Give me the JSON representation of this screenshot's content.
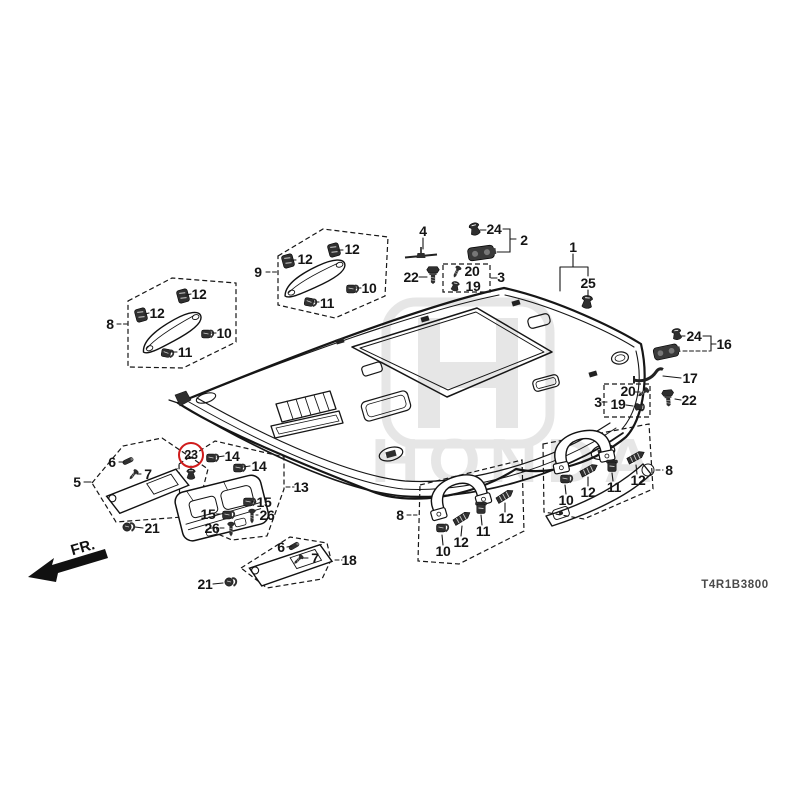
{
  "footer": {
    "diagram_code": "T4R1B3800"
  },
  "orientation": {
    "label": "FR."
  },
  "watermark": {
    "brand": "HONDA"
  },
  "highlight": {
    "label": "23",
    "ring_color": "#cf1b1b"
  },
  "callouts": [
    {
      "label": "4",
      "x": 423,
      "y": 231
    },
    {
      "label": "24",
      "x": 494,
      "y": 229
    },
    {
      "label": "2",
      "x": 524,
      "y": 240
    },
    {
      "label": "22",
      "x": 411,
      "y": 277
    },
    {
      "label": "20",
      "x": 472,
      "y": 271
    },
    {
      "label": "19",
      "x": 473,
      "y": 286
    },
    {
      "label": "3",
      "x": 501,
      "y": 277
    },
    {
      "label": "1",
      "x": 573,
      "y": 247
    },
    {
      "label": "25",
      "x": 588,
      "y": 283
    },
    {
      "label": "9",
      "x": 258,
      "y": 272
    },
    {
      "label": "12",
      "x": 305,
      "y": 259
    },
    {
      "label": "12",
      "x": 352,
      "y": 249
    },
    {
      "label": "10",
      "x": 369,
      "y": 288
    },
    {
      "label": "11",
      "x": 327,
      "y": 303
    },
    {
      "label": "8",
      "x": 110,
      "y": 324
    },
    {
      "label": "12",
      "x": 199,
      "y": 294
    },
    {
      "label": "12",
      "x": 157,
      "y": 313
    },
    {
      "label": "10",
      "x": 224,
      "y": 333
    },
    {
      "label": "11",
      "x": 185,
      "y": 352
    },
    {
      "label": "24",
      "x": 694,
      "y": 336
    },
    {
      "label": "16",
      "x": 724,
      "y": 344
    },
    {
      "label": "17",
      "x": 690,
      "y": 378
    },
    {
      "label": "20",
      "x": 628,
      "y": 391
    },
    {
      "label": "19",
      "x": 618,
      "y": 404
    },
    {
      "label": "3",
      "x": 598,
      "y": 402
    },
    {
      "label": "22",
      "x": 689,
      "y": 400
    },
    {
      "label": "23",
      "x": 191,
      "y": 455,
      "circled": true
    },
    {
      "label": "14",
      "x": 232,
      "y": 456
    },
    {
      "label": "14",
      "x": 259,
      "y": 466
    },
    {
      "label": "13",
      "x": 301,
      "y": 487
    },
    {
      "label": "15",
      "x": 264,
      "y": 502
    },
    {
      "label": "26",
      "x": 267,
      "y": 515
    },
    {
      "label": "15",
      "x": 208,
      "y": 514
    },
    {
      "label": "26",
      "x": 212,
      "y": 528
    },
    {
      "label": "5",
      "x": 77,
      "y": 482
    },
    {
      "label": "6",
      "x": 112,
      "y": 462
    },
    {
      "label": "7",
      "x": 148,
      "y": 474
    },
    {
      "label": "21",
      "x": 152,
      "y": 528
    },
    {
      "label": "6",
      "x": 281,
      "y": 547
    },
    {
      "label": "7",
      "x": 315,
      "y": 558
    },
    {
      "label": "18",
      "x": 349,
      "y": 560
    },
    {
      "label": "21",
      "x": 205,
      "y": 584
    },
    {
      "label": "8",
      "x": 400,
      "y": 515
    },
    {
      "label": "10",
      "x": 443,
      "y": 551
    },
    {
      "label": "12",
      "x": 461,
      "y": 542
    },
    {
      "label": "11",
      "x": 483,
      "y": 531
    },
    {
      "label": "12",
      "x": 506,
      "y": 518
    },
    {
      "label": "8",
      "x": 669,
      "y": 470
    },
    {
      "label": "10",
      "x": 566,
      "y": 500
    },
    {
      "label": "12",
      "x": 588,
      "y": 492
    },
    {
      "label": "11",
      "x": 614,
      "y": 487
    },
    {
      "label": "12",
      "x": 638,
      "y": 480
    }
  ]
}
